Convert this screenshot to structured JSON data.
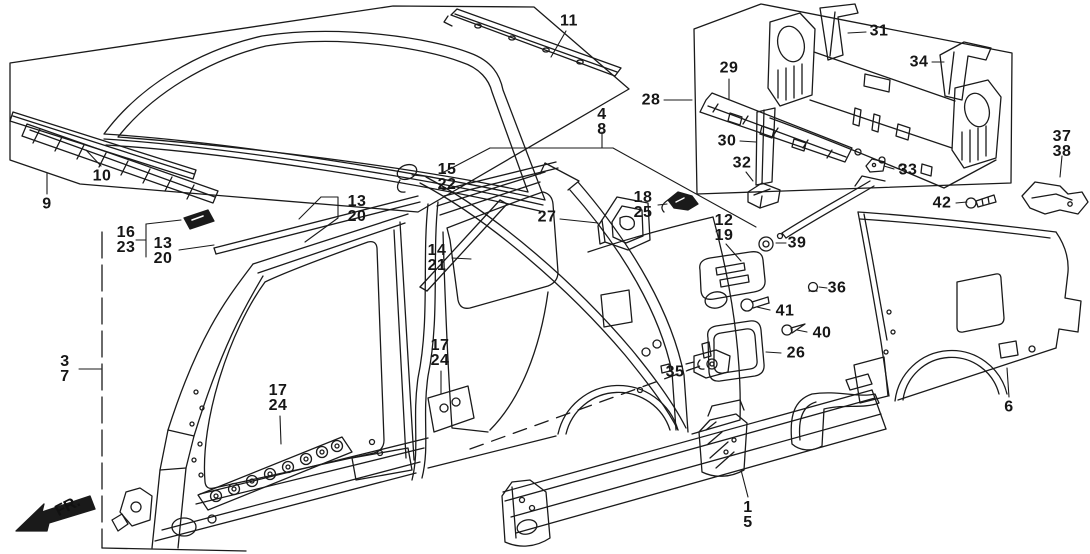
{
  "figure": {
    "background": "#ffffff",
    "line_color": "#1a1a1a",
    "description": "Exploded parts diagram of car body outer panels: roof, side panel, sill, rear panel and quarter panel with numbered callouts"
  },
  "fr_label": "FR.",
  "callouts": [
    {
      "id": "9",
      "lines": [
        "9"
      ]
    },
    {
      "id": "10",
      "lines": [
        "10"
      ]
    },
    {
      "id": "11",
      "lines": [
        "11"
      ]
    },
    {
      "id": "4-8",
      "lines": [
        "4",
        "8"
      ]
    },
    {
      "id": "28",
      "lines": [
        "28"
      ]
    },
    {
      "id": "29",
      "lines": [
        "29"
      ]
    },
    {
      "id": "31",
      "lines": [
        "31"
      ]
    },
    {
      "id": "34",
      "lines": [
        "34"
      ]
    },
    {
      "id": "30",
      "lines": [
        "30"
      ]
    },
    {
      "id": "32",
      "lines": [
        "32"
      ]
    },
    {
      "id": "33",
      "lines": [
        "33"
      ]
    },
    {
      "id": "37-38",
      "lines": [
        "37",
        "38"
      ]
    },
    {
      "id": "42",
      "lines": [
        "42"
      ]
    },
    {
      "id": "16-23",
      "lines": [
        "16",
        "23"
      ]
    },
    {
      "id": "13-20-left",
      "lines": [
        "13",
        "20"
      ]
    },
    {
      "id": "13-20-mid",
      "lines": [
        "13",
        "20"
      ]
    },
    {
      "id": "15-22",
      "lines": [
        "15",
        "22"
      ]
    },
    {
      "id": "14-21",
      "lines": [
        "14",
        "21"
      ]
    },
    {
      "id": "27",
      "lines": [
        "27"
      ]
    },
    {
      "id": "18-25",
      "lines": [
        "18",
        "25"
      ]
    },
    {
      "id": "12-19",
      "lines": [
        "12",
        "19"
      ]
    },
    {
      "id": "39",
      "lines": [
        "39"
      ]
    },
    {
      "id": "36",
      "lines": [
        "36"
      ]
    },
    {
      "id": "41",
      "lines": [
        "41"
      ]
    },
    {
      "id": "40",
      "lines": [
        "40"
      ]
    },
    {
      "id": "26",
      "lines": [
        "26"
      ]
    },
    {
      "id": "35",
      "lines": [
        "35"
      ]
    },
    {
      "id": "17-24-left",
      "lines": [
        "17",
        "24"
      ]
    },
    {
      "id": "17-24-right",
      "lines": [
        "17",
        "24"
      ]
    },
    {
      "id": "3-7",
      "lines": [
        "3",
        "7"
      ]
    },
    {
      "id": "1-5",
      "lines": [
        "1",
        "5"
      ]
    },
    {
      "id": "6",
      "lines": [
        "6"
      ]
    }
  ]
}
